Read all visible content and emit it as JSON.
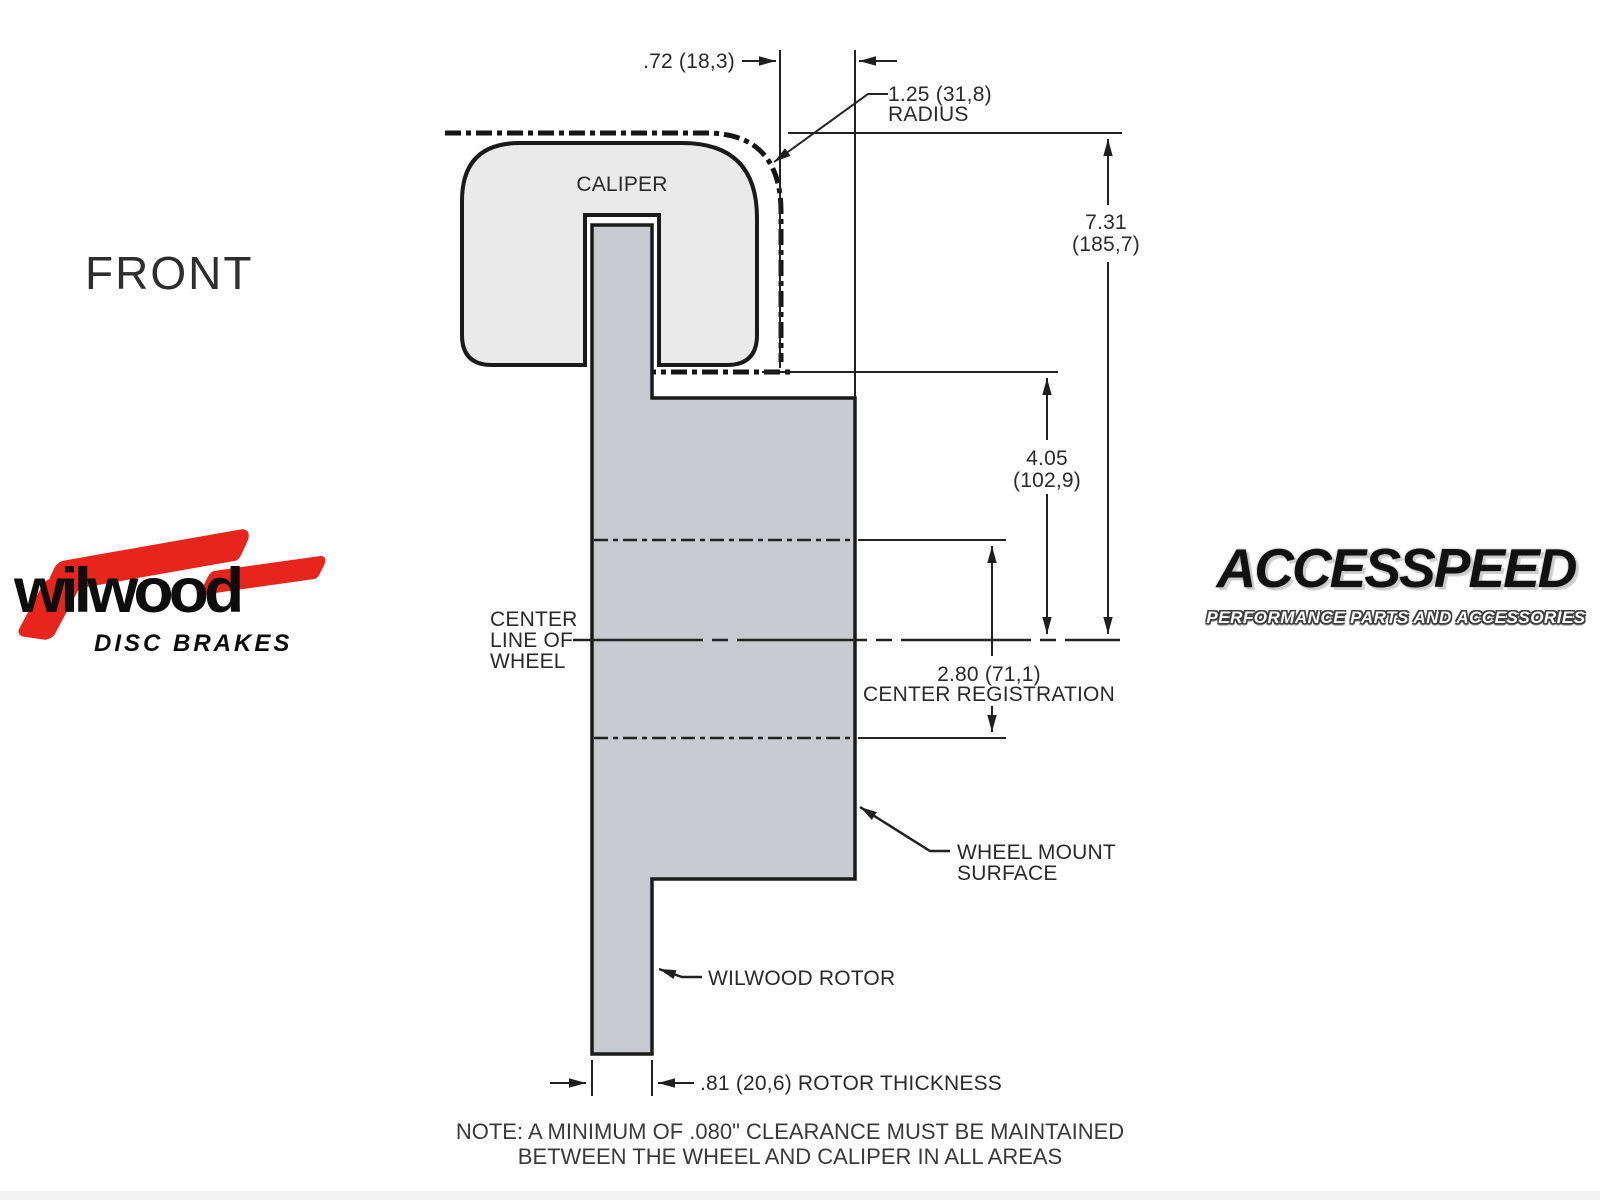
{
  "page": {
    "background": "#ffffff"
  },
  "view_label": "FRONT",
  "diagram": {
    "caliper_label": "CALIPER",
    "colors": {
      "caliper_fill": "#eaeaea",
      "rotor_fill": "#c9cad0",
      "line": "#1f1f1f",
      "accent_red": "#e8251c"
    },
    "dimensions": {
      "wheel_offset": ".72 (18,3)",
      "radius_value": "1.25 (31,8)",
      "radius_word": "RADIUS",
      "overall_height_in": "7.31",
      "overall_height_mm": "(185,7)",
      "mount_height_in": "4.05",
      "mount_height_mm": "(102,9)",
      "register_value": "2.80 (71,1)",
      "register_word": "CENTER REGISTRATION",
      "rotor_thickness": ".81 (20,6) ROTOR THICKNESS"
    },
    "labels": {
      "centerline_1": "CENTER",
      "centerline_2": "LINE OF",
      "centerline_3": "WHEEL",
      "wheel_mount_1": "WHEEL MOUNT",
      "wheel_mount_2": "SURFACE",
      "rotor": "WILWOOD ROTOR"
    }
  },
  "note": {
    "line1": "NOTE: A MINIMUM OF .080\" CLEARANCE MUST BE MAINTAINED",
    "line2": "BETWEEN THE WHEEL AND CALIPER IN ALL AREAS"
  },
  "logos": {
    "wilwood": {
      "name": "wilwood",
      "tagline": "DISC BRAKES"
    },
    "accesspeed": {
      "name": "ACCESSPEED",
      "tagline": "PERFORMANCE PARTS AND ACCESSORIES"
    }
  }
}
